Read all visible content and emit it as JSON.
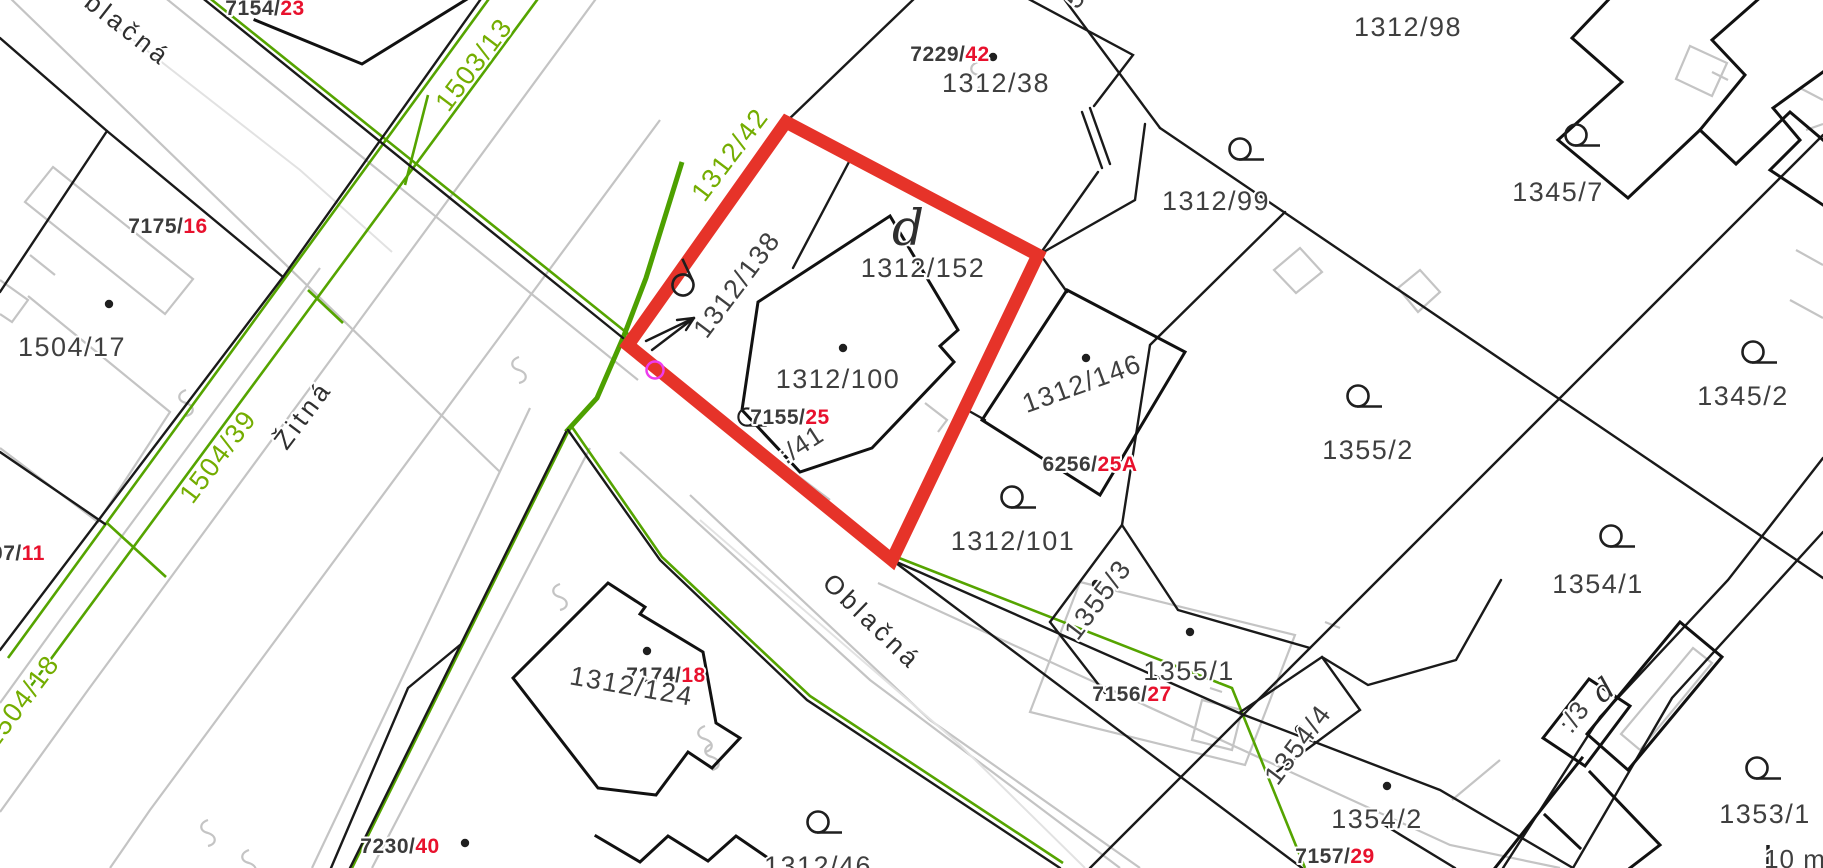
{
  "map_type": "cadastral-map",
  "highlight": {
    "selected_parcel": "1312/152",
    "outline_color": "#e63329"
  },
  "colors": {
    "parcel_line": "#1a1a1a",
    "usage_line_green": "#55a400",
    "green_label": "#74ad00",
    "house_number_red": "#e8112d",
    "building_gray": "#c4c4c4",
    "marker_magenta": "#ee3cee"
  },
  "scale": {
    "label": "10 m"
  },
  "streets": {
    "oblacna_top": "Oblačná",
    "zitna": "Žitná",
    "oblacna_bottom": "Oblačná"
  },
  "labels": {
    "p7154": "7154/",
    "p7154_no": "23",
    "p7175": "7175/",
    "p7175_no": "16",
    "g1503_13": "1503/13",
    "g1312_42": "1312/42",
    "p1504_17": "1504/17",
    "g1504_39": "1504/39",
    "p07": "07/",
    "p07_no": "11",
    "g1504_18": "1504/18",
    "p7230": "7230/",
    "p7230_no": "40",
    "p1312_46": "1312/46",
    "p7174": "7174/",
    "p7174_no": "18",
    "p1312_124": "1312/124",
    "p7229": "7229/",
    "p7229_no": "42",
    "p1312_38": "1312/38",
    "frag_top": "5",
    "p1312_99": "1312/99",
    "p1312_98": "1312/98",
    "p1345_7": "1345/7",
    "p1345_2": "1345/2",
    "p1355_2": "1355/2",
    "p1312_146": "1312/146",
    "p6256": "6256/",
    "p6256_no": "25A",
    "p1312_101": "1312/101",
    "p1355_3": "1355/3",
    "p1355_1": "1355/1",
    "p7156": "7156/",
    "p7156_no": "27",
    "p1354_4": "1354/4",
    "p7157": "7157/",
    "p7157_no": "29",
    "p1354_2": "1354/2",
    "p1354_1": "1354/1",
    "p_3": ":/3",
    "d_small": "d",
    "p1353_1": "1353/1",
    "d_big": "d",
    "p1312_152": "1312/152",
    "p1312_100": "1312/100",
    "p7155": "7155/",
    "p7155_no": "25",
    "p_41": ":/41",
    "p1312_138": "1312/138",
    "scale_label": "10 m"
  }
}
